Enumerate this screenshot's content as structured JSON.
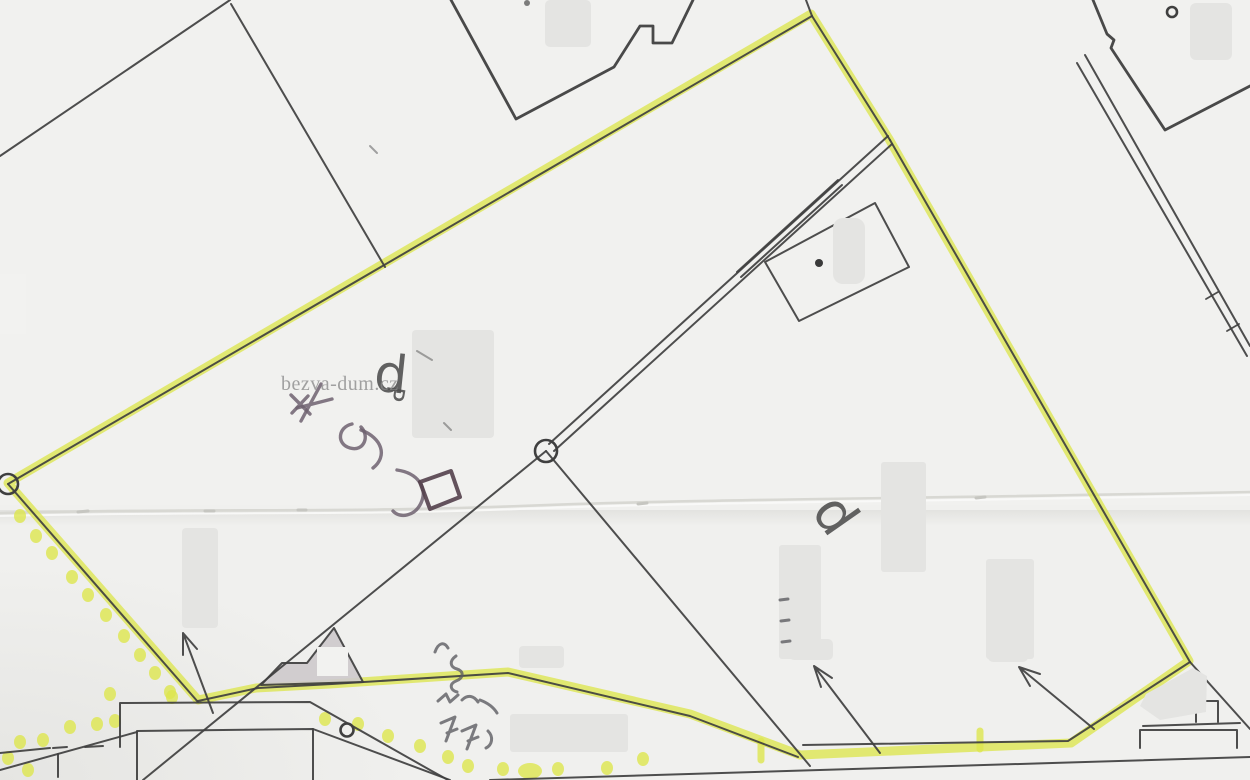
{
  "document": {
    "kind": "scanned cadastral parcel map with yellow highlighter markup",
    "watermark": "bezva-dum.cz"
  },
  "labels": {
    "parcel_letter_upper": "d",
    "parcel_letter_upper_secondary": "P",
    "parcel_letter_right": "d"
  },
  "handwriting": {
    "note_center": "illegible pencil scrawl with small square symbol",
    "note_bottom": "illegible pencil squiggles (measurement-like marks)"
  },
  "colors": {
    "paper": "#f0f0ee",
    "ink": "#3f3f3f",
    "highlighter": "#dde64e",
    "pencil": "#6e6170",
    "building_fill": "#cfcbcd",
    "redaction": "#e4e4e2"
  }
}
